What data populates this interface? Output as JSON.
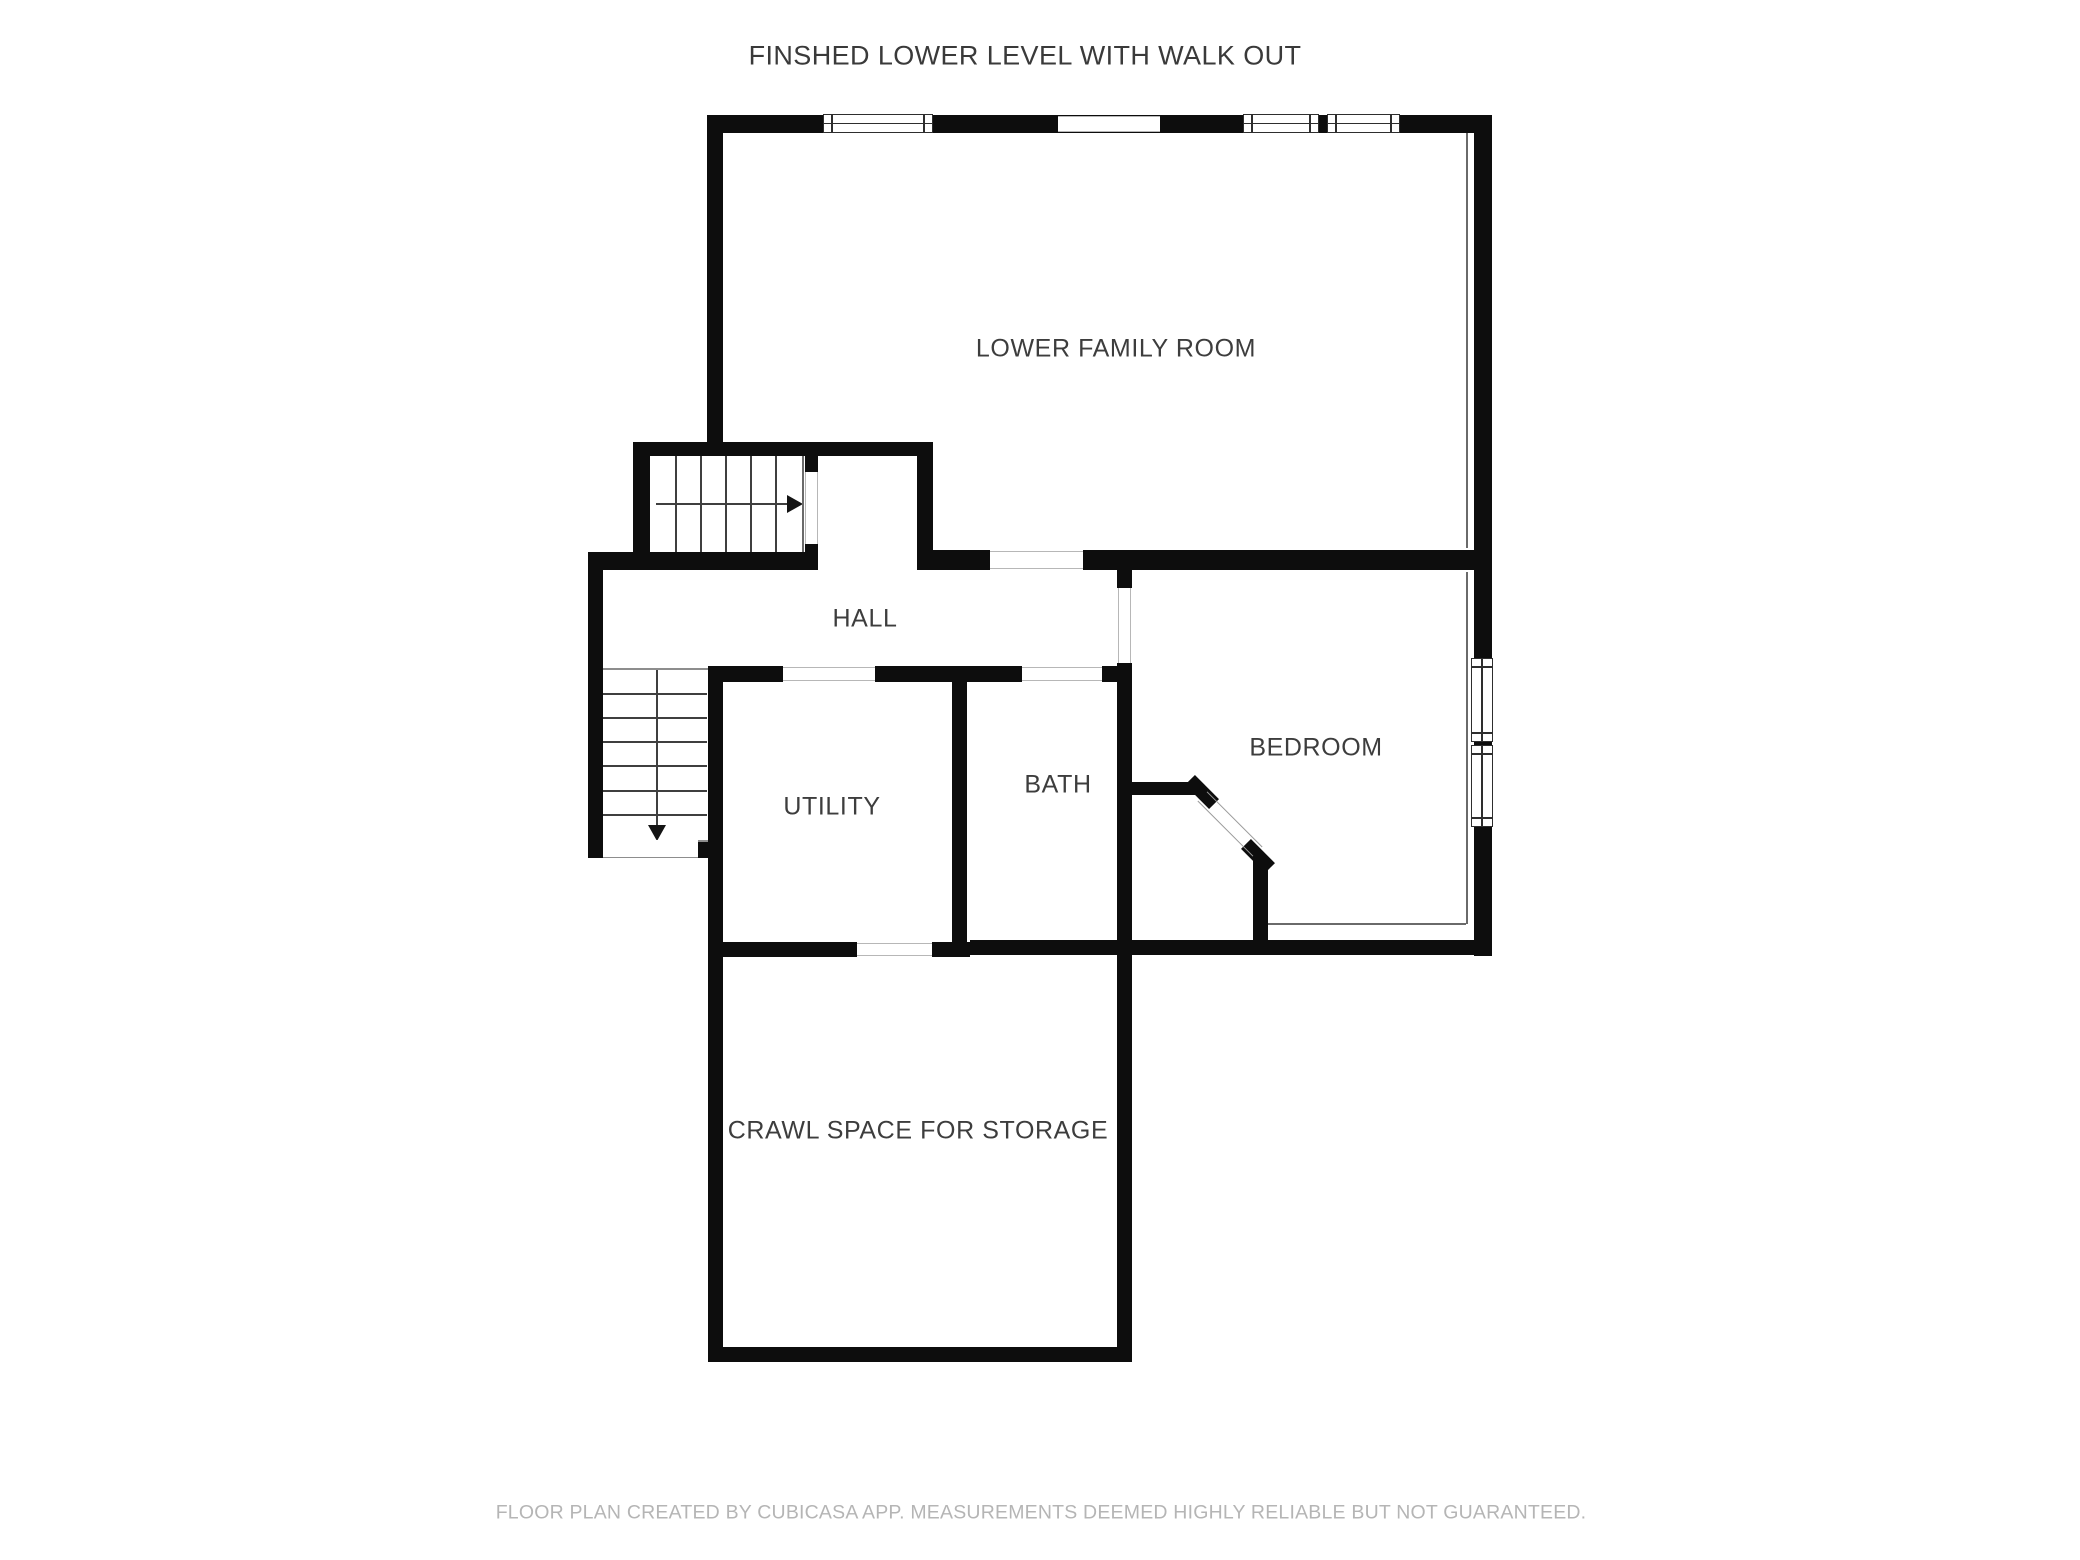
{
  "header": {
    "title": "FINSHED LOWER LEVEL WITH WALK OUT",
    "pos": {
      "cx": 1025,
      "cy": 56
    }
  },
  "footer": {
    "text": "FLOOR PLAN CREATED BY CUBICASA APP. MEASUREMENTS DEEMED HIGHLY RELIABLE BUT NOT GUARANTEED.",
    "pos": {
      "cx": 1041,
      "cy": 1513
    }
  },
  "rooms": [
    {
      "id": "lower-family-room",
      "label": "LOWER FAMILY ROOM",
      "cx": 1116,
      "cy": 349
    },
    {
      "id": "hall",
      "label": "HALL",
      "cx": 865,
      "cy": 619
    },
    {
      "id": "utility",
      "label": "UTILITY",
      "cx": 832,
      "cy": 807
    },
    {
      "id": "bath",
      "label": "BATH",
      "cx": 1058,
      "cy": 785
    },
    {
      "id": "bedroom",
      "label": "BEDROOM",
      "cx": 1316,
      "cy": 748
    },
    {
      "id": "crawl-space",
      "label": "CRAWL SPACE FOR STORAGE",
      "cx": 918,
      "cy": 1131
    }
  ],
  "colors": {
    "wall": "#0d0d0d",
    "label_text": "#3d3d3d",
    "footer_text": "#b5b5b5",
    "opening_edge": "#b7b7b7",
    "window_frame": "#2e2e2e",
    "stair_line": "#3f3f3f",
    "room_outline": "#6a6a6a"
  },
  "floorplan": {
    "canvas": {
      "w": 2080,
      "h": 1560
    },
    "walls": [
      {
        "x": 707,
        "y": 115,
        "w": 785,
        "h": 18
      },
      {
        "x": 707,
        "y": 115,
        "w": 16,
        "h": 341
      },
      {
        "x": 1474,
        "y": 115,
        "w": 18,
        "h": 841
      },
      {
        "x": 633,
        "y": 442,
        "w": 300,
        "h": 14
      },
      {
        "x": 633,
        "y": 442,
        "w": 17,
        "h": 114
      },
      {
        "x": 805,
        "y": 456,
        "w": 13,
        "h": 16
      },
      {
        "x": 805,
        "y": 544,
        "w": 13,
        "h": 26
      },
      {
        "x": 917,
        "y": 442,
        "w": 16,
        "h": 128
      },
      {
        "x": 933,
        "y": 550,
        "w": 57,
        "h": 20
      },
      {
        "x": 1083,
        "y": 550,
        "w": 391,
        "h": 20
      },
      {
        "x": 588,
        "y": 552,
        "w": 230,
        "h": 18
      },
      {
        "x": 588,
        "y": 552,
        "w": 15,
        "h": 306
      },
      {
        "x": 723,
        "y": 666,
        "w": 60,
        "h": 16
      },
      {
        "x": 875,
        "y": 666,
        "w": 147,
        "h": 16
      },
      {
        "x": 1102,
        "y": 666,
        "w": 30,
        "h": 16
      },
      {
        "x": 1117,
        "y": 570,
        "w": 15,
        "h": 18
      },
      {
        "x": 1117,
        "y": 663,
        "w": 15,
        "h": 699
      },
      {
        "x": 708,
        "y": 666,
        "w": 15,
        "h": 696
      },
      {
        "x": 698,
        "y": 842,
        "w": 25,
        "h": 16
      },
      {
        "x": 952,
        "y": 682,
        "w": 15,
        "h": 260
      },
      {
        "x": 723,
        "y": 942,
        "w": 134,
        "h": 15
      },
      {
        "x": 932,
        "y": 942,
        "w": 38,
        "h": 15
      },
      {
        "x": 970,
        "y": 940,
        "w": 147,
        "h": 15
      },
      {
        "x": 1132,
        "y": 940,
        "w": 360,
        "h": 15
      },
      {
        "x": 708,
        "y": 1347,
        "w": 424,
        "h": 15
      },
      {
        "x": 1132,
        "y": 782,
        "w": 63,
        "h": 13
      },
      {
        "x": 1253,
        "y": 858,
        "w": 15,
        "h": 82
      }
    ],
    "diag_walls": [
      {
        "cx": 1202,
        "cy": 792,
        "len": 34,
        "th": 14
      },
      {
        "cx": 1258,
        "cy": 856,
        "len": 34,
        "th": 14
      }
    ],
    "diag_door": {
      "cx": 1230,
      "cy": 824,
      "len": 78,
      "th": 14
    },
    "openings": [
      {
        "x": 1058,
        "y": 116,
        "w": 102,
        "h": 16,
        "dir": "h"
      },
      {
        "x": 990,
        "y": 551,
        "w": 93,
        "h": 18,
        "dir": "h"
      },
      {
        "x": 783,
        "y": 667,
        "w": 92,
        "h": 14,
        "dir": "h"
      },
      {
        "x": 1022,
        "y": 667,
        "w": 80,
        "h": 14,
        "dir": "h"
      },
      {
        "x": 857,
        "y": 943,
        "w": 75,
        "h": 13,
        "dir": "h"
      },
      {
        "x": 1118,
        "y": 588,
        "w": 13,
        "h": 75,
        "dir": "v"
      },
      {
        "x": 805,
        "y": 472,
        "w": 13,
        "h": 72,
        "dir": "v"
      }
    ],
    "windows": [
      {
        "x": 823,
        "y": 114,
        "w": 110,
        "h": 19,
        "dir": "h"
      },
      {
        "x": 1243,
        "y": 114,
        "w": 76,
        "h": 19,
        "dir": "h"
      },
      {
        "x": 1327,
        "y": 114,
        "w": 73,
        "h": 19,
        "dir": "h"
      },
      {
        "x": 1471,
        "y": 658,
        "w": 22,
        "h": 84,
        "dir": "v"
      },
      {
        "x": 1471,
        "y": 745,
        "w": 22,
        "h": 82,
        "dir": "v"
      }
    ],
    "thin_lines": [
      {
        "x": 1466,
        "y": 133,
        "w": 2,
        "h": 415
      },
      {
        "x": 1466,
        "y": 572,
        "w": 2,
        "h": 352
      },
      {
        "x": 1268,
        "y": 923,
        "w": 198,
        "h": 2
      },
      {
        "x": 802,
        "y": 456,
        "w": 2,
        "h": 96
      }
    ],
    "stairs": {
      "upper": {
        "y": 456,
        "h": 96,
        "treads_x": [
          675,
          700,
          725,
          750,
          775
        ],
        "shaft": {
          "x1": 656,
          "y": 504,
          "x2": 787
        },
        "arrow": "right"
      },
      "lower": {
        "x": 603,
        "w": 104,
        "treads_y": [
          693,
          717,
          741,
          765,
          790,
          814
        ],
        "edge_top": 668,
        "edge_bottom": 840,
        "shaft": {
          "x": 657,
          "y1": 670,
          "y2": 825
        },
        "arrow": "down"
      },
      "landing": {
        "x": 603,
        "y": 840,
        "w": 95,
        "h": 18
      }
    }
  }
}
